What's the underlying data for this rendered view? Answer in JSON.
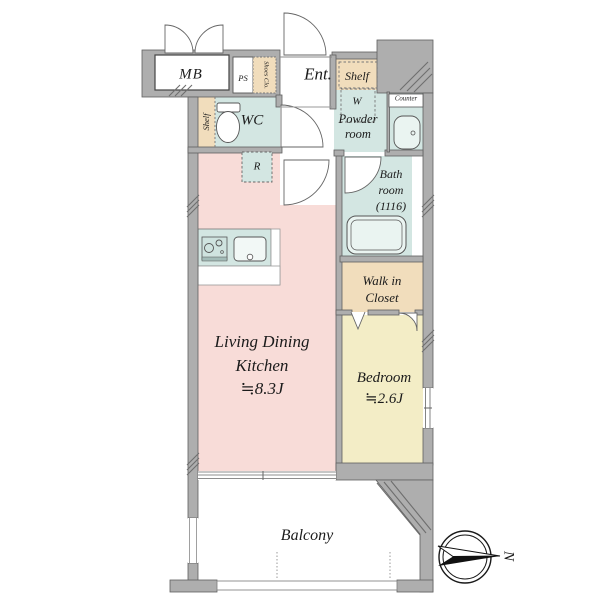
{
  "plan": {
    "labels": {
      "mb": "MB",
      "ps": "PS",
      "shoes_closet": "Shoes Clo.",
      "entrance": "Ent.",
      "shelf_entry": "Shelf",
      "washer": "W",
      "powder_line1": "Powder",
      "powder_line2": "room",
      "counter": "Counter",
      "bath_line1": "Bath",
      "bath_line2": "room",
      "bath_size": "(1116)",
      "shelf_wc": "Shelf",
      "wc": "WC",
      "refrigerator": "R",
      "closet_line1": "Walk in",
      "closet_line2": "Closet",
      "ldk_line1": "Living Dining",
      "ldk_line2": "Kitchen",
      "ldk_size": "≒8.3J",
      "bedroom_name": "Bedroom",
      "bedroom_size": "≒2.6J",
      "balcony": "Balcony",
      "north": "N"
    },
    "colors": {
      "wall_gray": "#aeaeae",
      "ldk_pink": "#f8dcd8",
      "bedroom_yellow": "#f3edc6",
      "wet_area_teal": "#d3e6e2",
      "storage_beige": "#f1ddbc",
      "outline": "#5f5f5f"
    }
  }
}
